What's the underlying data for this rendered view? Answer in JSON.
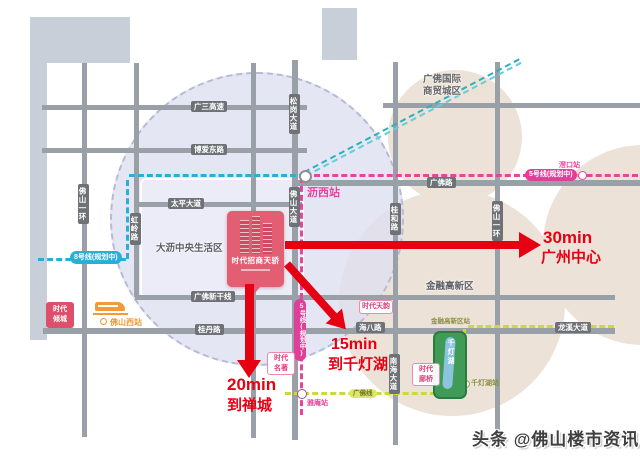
{
  "roads": {
    "guangsan_expressway": "广三高速",
    "boai_east": "博爱东路",
    "taiping_avenue": "太平大道",
    "guangfo_road": "广佛路",
    "guangfo_new_trunk": "广佛新干线",
    "guidan_road": "桂丹路",
    "haiba_road": "海八路",
    "longxi_avenue": "龙溪大道",
    "foshan_ring_west": "佛山一环",
    "honglin_road": "虹岭路",
    "songgang_avenue": "松岗大道",
    "foshan_avenue": "佛山大道",
    "guihe_road": "桂和路",
    "nanhai_avenue": "南海大道",
    "foshan_ring_east": "佛山一环"
  },
  "metro": {
    "line8_label": "8号线(规划中)",
    "line5_label": "5号线(规划中)",
    "jiaokou_station": "滘口站",
    "lixi_station": "沥西站",
    "yaan_station": "雅庵站",
    "guangfo_line_label": "广佛线",
    "jinrong_gaoxin_station": "金融高新区站",
    "qiandenghu_station": "千灯湖站"
  },
  "areas": {
    "dali_central": "大沥中央生活区",
    "gfic_line1": "广佛国际",
    "gfic_line2": "商贸城区",
    "financial_hitech": "金融高新区"
  },
  "landmarks": {
    "project_name": "时代招商天骄",
    "foshan_west_station": "佛山西站",
    "qiandenghu_lake": "千灯湖",
    "times_qingcheng_l1": "时代",
    "times_qingcheng_l2": "倾城",
    "times_mingzhu_l1": "时代",
    "times_mingzhu_l2": "名著",
    "times_tianyun": "时代天韵",
    "times_langqiao_l1": "时代",
    "times_langqiao_l2": "廊桥"
  },
  "arrows": {
    "to_guangzhou_time": "30min",
    "to_guangzhou_dest": "广州中心",
    "to_qiandenghu_time": "15min",
    "to_qiandenghu_dest": "到千灯湖",
    "to_chancheng_time": "20min",
    "to_chancheng_dest": "到禅城"
  },
  "watermark": "头条 @佛山楼市资讯",
  "colors": {
    "line8_cyan": "#29aed6",
    "line5_pink": "#e2469d",
    "guangfo_line_yellow_green": "#ccd93a",
    "intercity_teal": "#2ab0bd",
    "arrow_red": "#e50012",
    "road_gray": "#9aa0a7",
    "district_lavender": "#dfe0f1",
    "district_beige": "#ece2d7",
    "project_red": "#e25e72",
    "station_orange": "#f09a3a",
    "lake_green": "#3f9b55"
  }
}
